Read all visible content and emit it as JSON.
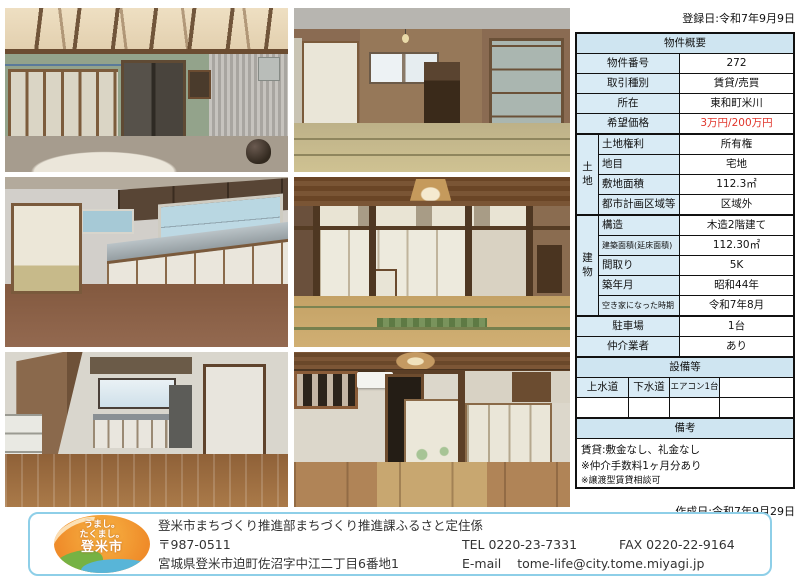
{
  "page": {
    "registration_date": "登録日:令和7年9月9日",
    "creation_date": "作成日:令和7年9月29日"
  },
  "photos": [
    {
      "name": "entrance-doma",
      "desc": "屋根付き土間・ガラス引き戸とトタン壁"
    },
    {
      "name": "tatami-room-2f",
      "desc": "2階和室・窓と木製棚"
    },
    {
      "name": "kitchen",
      "desc": "台所・白いキャビネットと窓"
    },
    {
      "name": "large-tatami-room",
      "desc": "和室・襖と木製天井の照明"
    },
    {
      "name": "wood-floor-room",
      "desc": "板間・階段下から台所方向"
    },
    {
      "name": "tatami-room-aircon",
      "desc": "和室・エアコンと襖"
    }
  ],
  "table": {
    "title": "物件概要",
    "rows_top": [
      {
        "label": "物件番号",
        "value": "272"
      },
      {
        "label": "取引種別",
        "value": "賃貸/売買"
      },
      {
        "label": "所在",
        "value": "東和町米川"
      },
      {
        "label": "希望価格",
        "value": "3万円/200万円"
      }
    ],
    "land": {
      "group": "土地",
      "rows": [
        {
          "label": "土地権利",
          "value": "所有権"
        },
        {
          "label": "地目",
          "value": "宅地"
        },
        {
          "label": "敷地面積",
          "value": "112.3㎡"
        },
        {
          "label": "都市計画区域等",
          "value": "区域外"
        }
      ]
    },
    "building": {
      "group": "建物",
      "rows": [
        {
          "label": "建築面積(延床面積)",
          "value": "112.30㎡"
        },
        {
          "label": "構造",
          "value": "木造2階建て"
        },
        {
          "label": "間取り",
          "value": "5K"
        },
        {
          "label": "築年月",
          "value": "昭和44年"
        },
        {
          "label": "空き家になった時期",
          "value": "令和7年8月"
        }
      ]
    },
    "rows_bottom": [
      {
        "label": "駐車場",
        "value": "1台"
      },
      {
        "label": "仲介業者",
        "value": "あり"
      }
    ],
    "equipment": {
      "title": "設備等",
      "cells": [
        "上水道",
        "下水道",
        "エアコン1台",
        ""
      ]
    },
    "remarks": {
      "title": "備考",
      "lines": [
        "賃貸:敷金なし、礼金なし",
        "※仲介手数料1ヶ月分あり",
        "※譲渡型賃貸相談可"
      ]
    }
  },
  "footer": {
    "logo": {
      "line1": "うまし。",
      "line2": "たくまし。",
      "line3": "登米市"
    },
    "department": "登米市まちづくり推進部まちづくり推進課ふるさと定住係",
    "postal_code": "〒987-0511",
    "address": "宮城県登米市迫町佐沼字中江二丁目6番地1",
    "tel": "TEL 0220-23-7331",
    "fax": "FAX 0220-22-9164",
    "email_label": "E-mail",
    "email": "tome-life@city.tome.miyagi.jp"
  },
  "colors": {
    "table_header_bg": "#cfe5f1",
    "table_label_bg": "#d9ebf5",
    "price_red": "#e0342a",
    "footer_border": "#8ecfe8",
    "logo_orange": "#ef8c2a",
    "logo_green": "#76b244",
    "logo_blue": "#58b5d8"
  }
}
